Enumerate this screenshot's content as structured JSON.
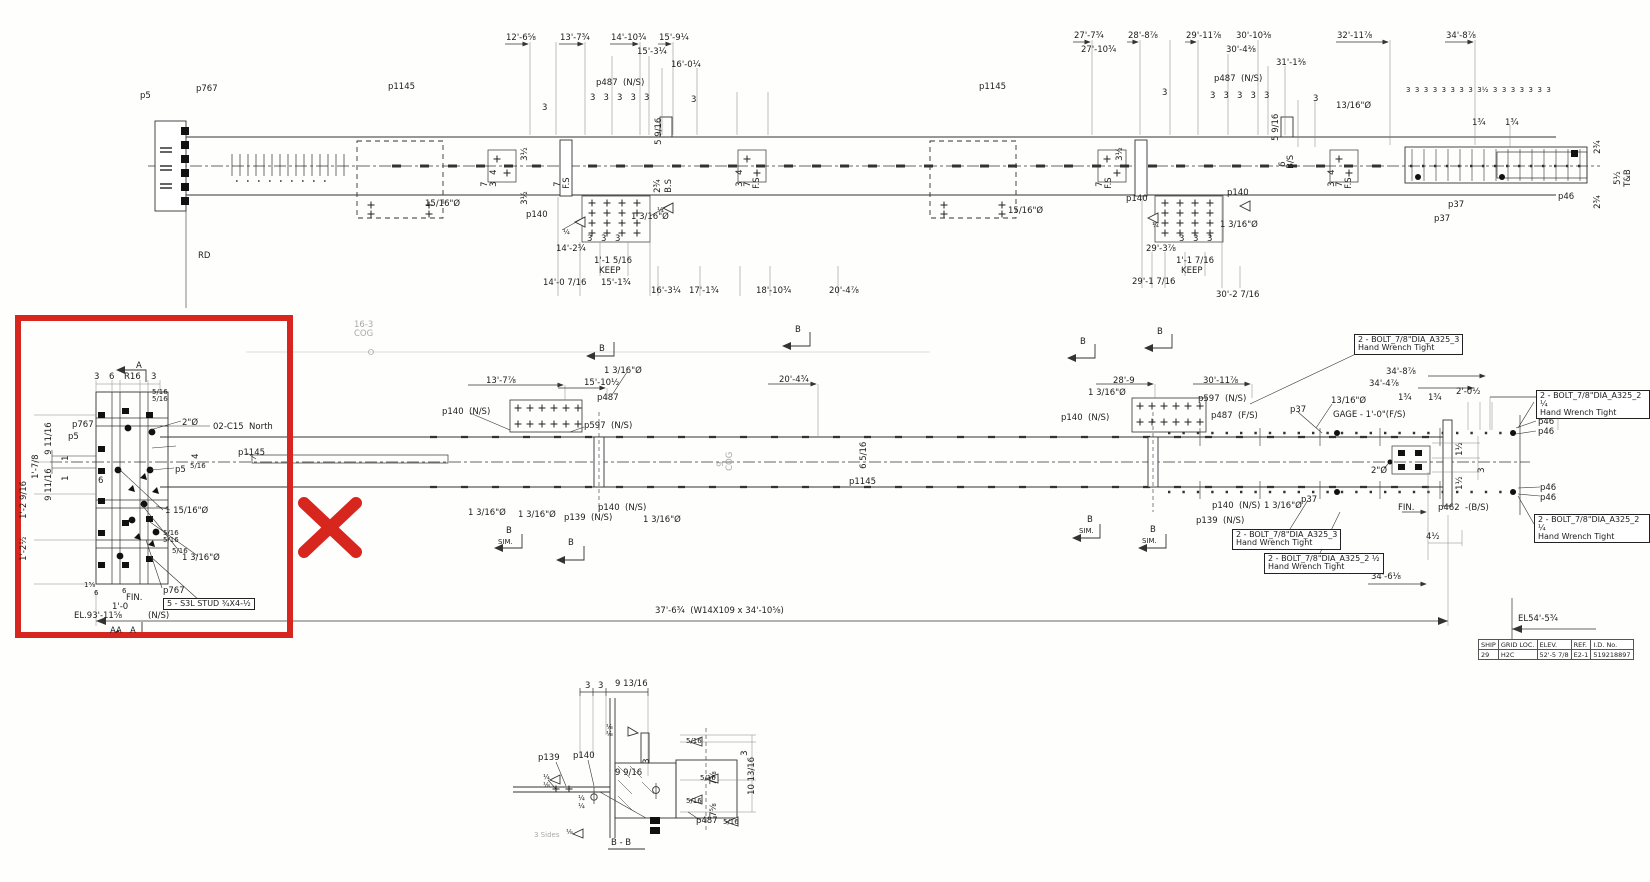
{
  "red": {
    "color": "#d7261e"
  },
  "top": {
    "labels": [
      {
        "t": "p5",
        "x": 140,
        "y": 92
      },
      {
        "t": "p767",
        "x": 196,
        "y": 85
      },
      {
        "t": "p1145",
        "x": 388,
        "y": 83
      },
      {
        "t": "15/16\"Ø",
        "x": 425,
        "y": 200
      },
      {
        "t": "RD",
        "x": 198,
        "y": 252
      },
      {
        "t": "12'-6⅝",
        "x": 506,
        "y": 34
      },
      {
        "t": "13'-7¾",
        "x": 560,
        "y": 34
      },
      {
        "t": "14'-10¾",
        "x": 611,
        "y": 34
      },
      {
        "t": "15'-9¼",
        "x": 659,
        "y": 34
      },
      {
        "t": "15'-3¼",
        "x": 637,
        "y": 48
      },
      {
        "t": "16'-0¼",
        "x": 671,
        "y": 61
      },
      {
        "t": "p487  (N/S)",
        "x": 596,
        "y": 79
      },
      {
        "t": "3   3   3   3   3",
        "x": 590,
        "y": 94
      },
      {
        "t": "3",
        "x": 542,
        "y": 104
      },
      {
        "t": "3",
        "x": 691,
        "y": 96
      },
      {
        "t": "5 9/16",
        "x": 664,
        "y": 136,
        "c": "v"
      },
      {
        "t": "3½",
        "x": 530,
        "y": 152,
        "c": "v"
      },
      {
        "t": "3½",
        "x": 530,
        "y": 196,
        "c": "v"
      },
      {
        "t": "7",
        "x": 490,
        "y": 178,
        "c": "v"
      },
      {
        "t": "4",
        "x": 499,
        "y": 166,
        "c": "v"
      },
      {
        "t": "3",
        "x": 499,
        "y": 178,
        "c": "v"
      },
      {
        "t": "7",
        "x": 563,
        "y": 178,
        "c": "v"
      },
      {
        "t": "F.S",
        "x": 572,
        "y": 180,
        "c": "v"
      },
      {
        "t": "2¾",
        "x": 663,
        "y": 184,
        "c": "v"
      },
      {
        "t": "B.S",
        "x": 674,
        "y": 184,
        "c": "v"
      },
      {
        "t": "4",
        "x": 745,
        "y": 166,
        "c": "v"
      },
      {
        "t": "3",
        "x": 745,
        "y": 178,
        "c": "v"
      },
      {
        "t": "7",
        "x": 753,
        "y": 178,
        "c": "v"
      },
      {
        "t": "F.S",
        "x": 762,
        "y": 180,
        "c": "v"
      },
      {
        "t": "p140",
        "x": 526,
        "y": 211
      },
      {
        "t": "¼",
        "x": 563,
        "y": 229,
        "c": "s"
      },
      {
        "t": "¼",
        "x": 657,
        "y": 207,
        "c": "s"
      },
      {
        "t": "1 3/16\"Ø",
        "x": 631,
        "y": 213
      },
      {
        "t": "3",
        "x": 587,
        "y": 235
      },
      {
        "t": "3",
        "x": 601,
        "y": 235
      },
      {
        "t": "3",
        "x": 615,
        "y": 235
      },
      {
        "t": "14'-2¾",
        "x": 556,
        "y": 245
      },
      {
        "t": "1'-1 5/16",
        "x": 594,
        "y": 257
      },
      {
        "t": "KEEP",
        "x": 599,
        "y": 267
      },
      {
        "t": "14'-0 7/16",
        "x": 543,
        "y": 279
      },
      {
        "t": "15'-1¾",
        "x": 601,
        "y": 279
      },
      {
        "t": "16'-3¼",
        "x": 651,
        "y": 287
      },
      {
        "t": "17'-1¾",
        "x": 689,
        "y": 287
      },
      {
        "t": "18'-10¾",
        "x": 756,
        "y": 287
      },
      {
        "t": "20'-4⅞",
        "x": 829,
        "y": 287
      },
      {
        "t": "p1145",
        "x": 979,
        "y": 83
      },
      {
        "t": "15/16\"Ø",
        "x": 1008,
        "y": 207
      },
      {
        "t": "27'-7¾",
        "x": 1074,
        "y": 32
      },
      {
        "t": "27'-10¾",
        "x": 1081,
        "y": 46
      },
      {
        "t": "28'-8⅞",
        "x": 1128,
        "y": 32
      },
      {
        "t": "29'-11⅞",
        "x": 1186,
        "y": 32
      },
      {
        "t": "30'-4⅜",
        "x": 1226,
        "y": 46
      },
      {
        "t": "30'-10⅜",
        "x": 1236,
        "y": 32
      },
      {
        "t": "31'-1⅜",
        "x": 1276,
        "y": 59
      },
      {
        "t": "32'-11⅞",
        "x": 1337,
        "y": 32
      },
      {
        "t": "34'-8⅞",
        "x": 1446,
        "y": 32
      },
      {
        "t": "p487  (N/S)",
        "x": 1214,
        "y": 75
      },
      {
        "t": "3   3   3   3   3",
        "x": 1210,
        "y": 92
      },
      {
        "t": "3",
        "x": 1162,
        "y": 89
      },
      {
        "t": "3",
        "x": 1313,
        "y": 95
      },
      {
        "t": "13/16\"Ø",
        "x": 1336,
        "y": 102
      },
      {
        "t": "5 9/16",
        "x": 1281,
        "y": 132,
        "c": "v"
      },
      {
        "t": "6",
        "x": 1288,
        "y": 158,
        "c": "v"
      },
      {
        "t": "B/S",
        "x": 1296,
        "y": 160,
        "c": "v"
      },
      {
        "t": "3½",
        "x": 1125,
        "y": 152,
        "c": "v"
      },
      {
        "t": "7",
        "x": 1105,
        "y": 178,
        "c": "v"
      },
      {
        "t": "F.S",
        "x": 1114,
        "y": 180,
        "c": "v"
      },
      {
        "t": "4",
        "x": 1337,
        "y": 166,
        "c": "v"
      },
      {
        "t": "3",
        "x": 1337,
        "y": 178,
        "c": "v"
      },
      {
        "t": "7",
        "x": 1345,
        "y": 178,
        "c": "v"
      },
      {
        "t": "F.S",
        "x": 1354,
        "y": 180,
        "c": "v"
      },
      {
        "t": "p140",
        "x": 1126,
        "y": 195
      },
      {
        "t": "p140",
        "x": 1227,
        "y": 189
      },
      {
        "t": "¼",
        "x": 1152,
        "y": 222,
        "c": "s"
      },
      {
        "t": "1 3/16\"Ø",
        "x": 1220,
        "y": 221
      },
      {
        "t": "3",
        "x": 1179,
        "y": 235
      },
      {
        "t": "3",
        "x": 1193,
        "y": 235
      },
      {
        "t": "3",
        "x": 1207,
        "y": 235
      },
      {
        "t": "29'-3⅞",
        "x": 1146,
        "y": 245
      },
      {
        "t": "1'-1 7/16",
        "x": 1176,
        "y": 257
      },
      {
        "t": "KEEP",
        "x": 1181,
        "y": 267
      },
      {
        "t": "29'-1 7/16",
        "x": 1132,
        "y": 278
      },
      {
        "t": "30'-2 7/16",
        "x": 1216,
        "y": 291
      },
      {
        "t": "3  3  3  3  3  3  3  3  3½  3  3  3  3  3  3  3",
        "x": 1406,
        "y": 87,
        "c": "s"
      },
      {
        "t": "1¾",
        "x": 1472,
        "y": 119
      },
      {
        "t": "1¾",
        "x": 1505,
        "y": 119
      },
      {
        "t": "p37",
        "x": 1448,
        "y": 201
      },
      {
        "t": "p37",
        "x": 1434,
        "y": 215
      },
      {
        "t": "p46",
        "x": 1558,
        "y": 193
      },
      {
        "t": "2¾",
        "x": 1603,
        "y": 145,
        "c": "v"
      },
      {
        "t": "5½",
        "x": 1623,
        "y": 176,
        "c": "v"
      },
      {
        "t": "T&B",
        "x": 1633,
        "y": 178,
        "c": "v"
      },
      {
        "t": "2¾",
        "x": 1603,
        "y": 200,
        "c": "v"
      }
    ]
  },
  "mid": {
    "labels": [
      {
        "t": "16-3",
        "x": 354,
        "y": 321,
        "c": "g"
      },
      {
        "t": "COG",
        "x": 354,
        "y": 330,
        "c": "g"
      },
      {
        "t": "B",
        "x": 599,
        "y": 345
      },
      {
        "t": "B",
        "x": 795,
        "y": 326
      },
      {
        "t": "B",
        "x": 1080,
        "y": 338
      },
      {
        "t": "B",
        "x": 1157,
        "y": 328
      },
      {
        "t": "13'-7⅞",
        "x": 486,
        "y": 377
      },
      {
        "t": "15'-10½",
        "x": 584,
        "y": 379
      },
      {
        "t": "1 3/16\"Ø",
        "x": 604,
        "y": 367
      },
      {
        "t": "p487",
        "x": 597,
        "y": 394
      },
      {
        "t": "p140  (N/S)",
        "x": 442,
        "y": 408
      },
      {
        "t": "p597  (N/S)",
        "x": 584,
        "y": 422
      },
      {
        "t": "20'-4¾",
        "x": 779,
        "y": 376
      },
      {
        "t": "9",
        "x": 726,
        "y": 458,
        "c": "g v"
      },
      {
        "t": "COG",
        "x": 735,
        "y": 462,
        "c": "g v"
      },
      {
        "t": "6 5/16",
        "x": 869,
        "y": 460,
        "c": "v"
      },
      {
        "t": "p1145",
        "x": 849,
        "y": 478
      },
      {
        "t": "p1145",
        "x": 238,
        "y": 449
      },
      {
        "t": "1 3/16\"Ø",
        "x": 468,
        "y": 509
      },
      {
        "t": "1 3/16\"Ø",
        "x": 518,
        "y": 511
      },
      {
        "t": "p139  (N/S)",
        "x": 564,
        "y": 514
      },
      {
        "t": "p140  (N/S)",
        "x": 598,
        "y": 504
      },
      {
        "t": "1 3/16\"Ø",
        "x": 643,
        "y": 516
      },
      {
        "t": "B",
        "x": 506,
        "y": 527
      },
      {
        "t": "SIM.",
        "x": 498,
        "y": 539,
        "c": "s"
      },
      {
        "t": "B",
        "x": 568,
        "y": 539
      },
      {
        "t": "28'-9",
        "x": 1113,
        "y": 377
      },
      {
        "t": "1 3/16\"Ø",
        "x": 1088,
        "y": 389
      },
      {
        "t": "30'-11⅞",
        "x": 1203,
        "y": 377
      },
      {
        "t": "p597  (N/S)",
        "x": 1198,
        "y": 395
      },
      {
        "t": "p487  (F/S)",
        "x": 1211,
        "y": 412
      },
      {
        "t": "p140  (N/S)",
        "x": 1061,
        "y": 414
      },
      {
        "t": "p37",
        "x": 1290,
        "y": 406
      },
      {
        "t": "13/16\"Ø",
        "x": 1331,
        "y": 397
      },
      {
        "t": "GAGE - 1'-0\"(F/S)",
        "x": 1333,
        "y": 411
      },
      {
        "t": "34'-8⅞",
        "x": 1386,
        "y": 368
      },
      {
        "t": "34'-4⅞",
        "x": 1369,
        "y": 380
      },
      {
        "t": "1¾",
        "x": 1398,
        "y": 394
      },
      {
        "t": "1¾",
        "x": 1428,
        "y": 394
      },
      {
        "t": "2'-0½",
        "x": 1456,
        "y": 388
      },
      {
        "t": "p46",
        "x": 1538,
        "y": 418
      },
      {
        "t": "p46",
        "x": 1538,
        "y": 428
      },
      {
        "t": "2\"Ø",
        "x": 1371,
        "y": 467
      },
      {
        "t": "1½",
        "x": 1465,
        "y": 447,
        "c": "v"
      },
      {
        "t": "3",
        "x": 1487,
        "y": 464,
        "c": "v"
      },
      {
        "t": "1½",
        "x": 1465,
        "y": 481,
        "c": "v"
      },
      {
        "t": "p46",
        "x": 1540,
        "y": 484
      },
      {
        "t": "p46",
        "x": 1540,
        "y": 494
      },
      {
        "t": "FIN.",
        "x": 1398,
        "y": 504
      },
      {
        "t": "p462  -(B/S)",
        "x": 1438,
        "y": 504
      },
      {
        "t": "4½",
        "x": 1426,
        "y": 533
      },
      {
        "t": "p37",
        "x": 1301,
        "y": 496
      },
      {
        "t": "1 3/16\"Ø",
        "x": 1264,
        "y": 502
      },
      {
        "t": "p140  (N/S)",
        "x": 1212,
        "y": 502
      },
      {
        "t": "p139  (N/S)",
        "x": 1196,
        "y": 517
      },
      {
        "t": "B",
        "x": 1087,
        "y": 516
      },
      {
        "t": "SIM.",
        "x": 1079,
        "y": 528,
        "c": "s"
      },
      {
        "t": "B",
        "x": 1150,
        "y": 526
      },
      {
        "t": "SIM.",
        "x": 1142,
        "y": 538,
        "c": "s"
      },
      {
        "t": "34'-6⅛",
        "x": 1371,
        "y": 573
      },
      {
        "t": "37'-6¾  (W14X109 x 34'-10⅝)",
        "x": 655,
        "y": 607
      },
      {
        "t": "EL54'-5¾",
        "x": 1518,
        "y": 615
      },
      {
        "t": "2  -  BOLT_7/8\"DIA_A325_3\nHand Wrench Tight",
        "x": 1354,
        "y": 334,
        "c": "b"
      },
      {
        "t": "2  -  BOLT_7/8\"DIA_A325_2 ¼\nHand Wrench Tight",
        "x": 1536,
        "y": 390,
        "c": "b"
      },
      {
        "t": "2  -  BOLT_7/8\"DIA_A325_2 ¼\nHand Wrench Tight",
        "x": 1534,
        "y": 514,
        "c": "b"
      },
      {
        "t": "2  -  BOLT_7/8\"DIA_A325_3\nHand Wrench Tight",
        "x": 1232,
        "y": 529,
        "c": "b"
      },
      {
        "t": "2  -  BOLT_7/8\"DIA_A325_2 ½\nHand Wrench Tight",
        "x": 1264,
        "y": 553,
        "c": "b"
      }
    ]
  },
  "detail": {
    "labels": [
      {
        "t": "3",
        "x": 94,
        "y": 373
      },
      {
        "t": "6",
        "x": 109,
        "y": 373
      },
      {
        "t": "R16",
        "x": 124,
        "y": 373
      },
      {
        "t": "3",
        "x": 151,
        "y": 373
      },
      {
        "t": "A",
        "x": 136,
        "y": 362
      },
      {
        "t": "5/16",
        "x": 152,
        "y": 389,
        "c": "s"
      },
      {
        "t": "5/16",
        "x": 152,
        "y": 396,
        "c": "s"
      },
      {
        "t": "2\"Ø",
        "x": 182,
        "y": 419
      },
      {
        "t": "02-C15  North",
        "x": 213,
        "y": 423
      },
      {
        "t": "p767",
        "x": 72,
        "y": 421
      },
      {
        "t": "p5",
        "x": 68,
        "y": 433
      },
      {
        "t": "9 11/16",
        "x": 54,
        "y": 446,
        "c": "v"
      },
      {
        "t": "1",
        "x": 71,
        "y": 452,
        "c": "v"
      },
      {
        "t": "1'-7/8",
        "x": 41,
        "y": 470,
        "c": "v"
      },
      {
        "t": "1",
        "x": 71,
        "y": 472,
        "c": "v"
      },
      {
        "t": "9 11/16",
        "x": 54,
        "y": 492,
        "c": "v"
      },
      {
        "t": "1'-2 9/16",
        "x": 29,
        "y": 510,
        "c": "v"
      },
      {
        "t": "1'-2½",
        "x": 29,
        "y": 552,
        "c": "v"
      },
      {
        "t": "4",
        "x": 201,
        "y": 450,
        "c": "v"
      },
      {
        "t": "6",
        "x": 98,
        "y": 477
      },
      {
        "t": "p5",
        "x": 175,
        "y": 466
      },
      {
        "t": "5/16",
        "x": 190,
        "y": 463,
        "c": "s"
      },
      {
        "t": "1 15/16\"Ø",
        "x": 165,
        "y": 507
      },
      {
        "t": "5/16",
        "x": 163,
        "y": 530,
        "c": "s"
      },
      {
        "t": "5/16",
        "x": 163,
        "y": 537,
        "c": "s"
      },
      {
        "t": "5/16",
        "x": 172,
        "y": 548,
        "c": "s"
      },
      {
        "t": "1 3/16\"Ø",
        "x": 182,
        "y": 554
      },
      {
        "t": "p767",
        "x": 163,
        "y": 587
      },
      {
        "t": "5  -  S3L STUD ¾X4-½",
        "x": 163,
        "y": 598,
        "c": "b"
      },
      {
        "t": "FIN.",
        "x": 126,
        "y": 594
      },
      {
        "t": "1'-0",
        "x": 112,
        "y": 603
      },
      {
        "t": "1⅝",
        "x": 84,
        "y": 582,
        "c": "s"
      },
      {
        "t": "6",
        "x": 94,
        "y": 590,
        "c": "s"
      },
      {
        "t": "6",
        "x": 122,
        "y": 588,
        "c": "s"
      },
      {
        "t": "EL.93'-11⅝",
        "x": 74,
        "y": 612
      },
      {
        "t": "(N/S)",
        "x": 148,
        "y": 612
      },
      {
        "t": "AA",
        "x": 110,
        "y": 627
      },
      {
        "t": "A",
        "x": 130,
        "y": 627
      }
    ]
  },
  "bb": {
    "labels": [
      {
        "t": "3",
        "x": 585,
        "y": 682
      },
      {
        "t": "3",
        "x": 598,
        "y": 682
      },
      {
        "t": "9 13/16",
        "x": 615,
        "y": 680
      },
      {
        "t": "⅛",
        "x": 606,
        "y": 724,
        "c": "s"
      },
      {
        "t": "⅛",
        "x": 606,
        "y": 731,
        "c": "s"
      },
      {
        "t": "p139",
        "x": 538,
        "y": 754
      },
      {
        "t": "p140",
        "x": 573,
        "y": 752
      },
      {
        "t": "9 9/16",
        "x": 615,
        "y": 769
      },
      {
        "t": "3",
        "x": 652,
        "y": 755,
        "c": "v"
      },
      {
        "t": "5/16",
        "x": 686,
        "y": 738,
        "c": "s"
      },
      {
        "t": "3",
        "x": 750,
        "y": 747,
        "c": "v"
      },
      {
        "t": "7⅝",
        "x": 719,
        "y": 776,
        "c": "v"
      },
      {
        "t": "10 13/16",
        "x": 757,
        "y": 786,
        "c": "v"
      },
      {
        "t": "5/16",
        "x": 700,
        "y": 775,
        "c": "s"
      },
      {
        "t": "7⅝",
        "x": 719,
        "y": 808,
        "c": "v"
      },
      {
        "t": "5/16",
        "x": 686,
        "y": 798,
        "c": "s"
      },
      {
        "t": "¼",
        "x": 543,
        "y": 774,
        "c": "s"
      },
      {
        "t": "⅛",
        "x": 543,
        "y": 782,
        "c": "s"
      },
      {
        "t": "¼",
        "x": 578,
        "y": 795,
        "c": "s"
      },
      {
        "t": "¼",
        "x": 578,
        "y": 803,
        "c": "s"
      },
      {
        "t": "3 Sides",
        "x": 534,
        "y": 832,
        "c": "s g"
      },
      {
        "t": "⅛",
        "x": 566,
        "y": 829,
        "c": "s"
      },
      {
        "t": "p487",
        "x": 696,
        "y": 817
      },
      {
        "t": "5/16",
        "x": 723,
        "y": 819,
        "c": "s"
      },
      {
        "t": "B - B",
        "x": 611,
        "y": 839
      }
    ]
  },
  "table": {
    "headers": [
      "SHIP",
      "GRID LOC.",
      "ELEV.",
      "REF.",
      "I.D. No."
    ],
    "row": [
      "29",
      "H2C",
      "52'-5 7/8",
      "E2-1",
      "519218897"
    ]
  }
}
